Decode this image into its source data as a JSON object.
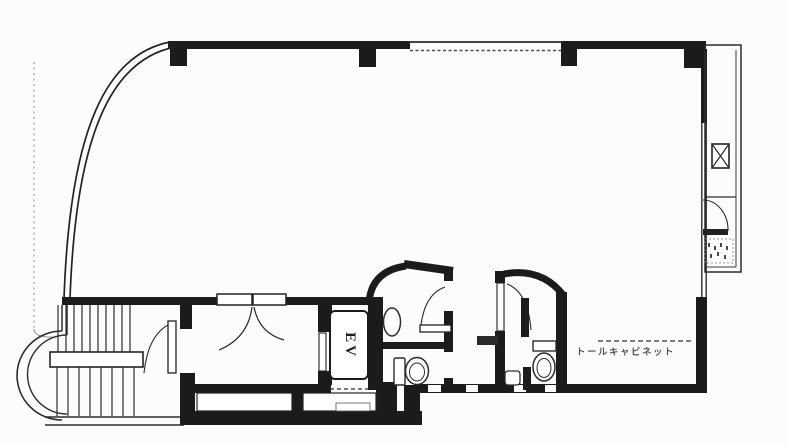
{
  "plan": {
    "labels": {
      "elevator": "EV",
      "cabinet_annotation": "トールキャビネット"
    },
    "symbols": {
      "pipe_space_box": "crossed-rectangle"
    },
    "colors": {
      "background": "#fcfcfa",
      "wall": "#1b1b1b",
      "thin_line": "#2c2c2c",
      "faint_line": "#9a9a9a",
      "annotation_text": "#383838"
    }
  }
}
